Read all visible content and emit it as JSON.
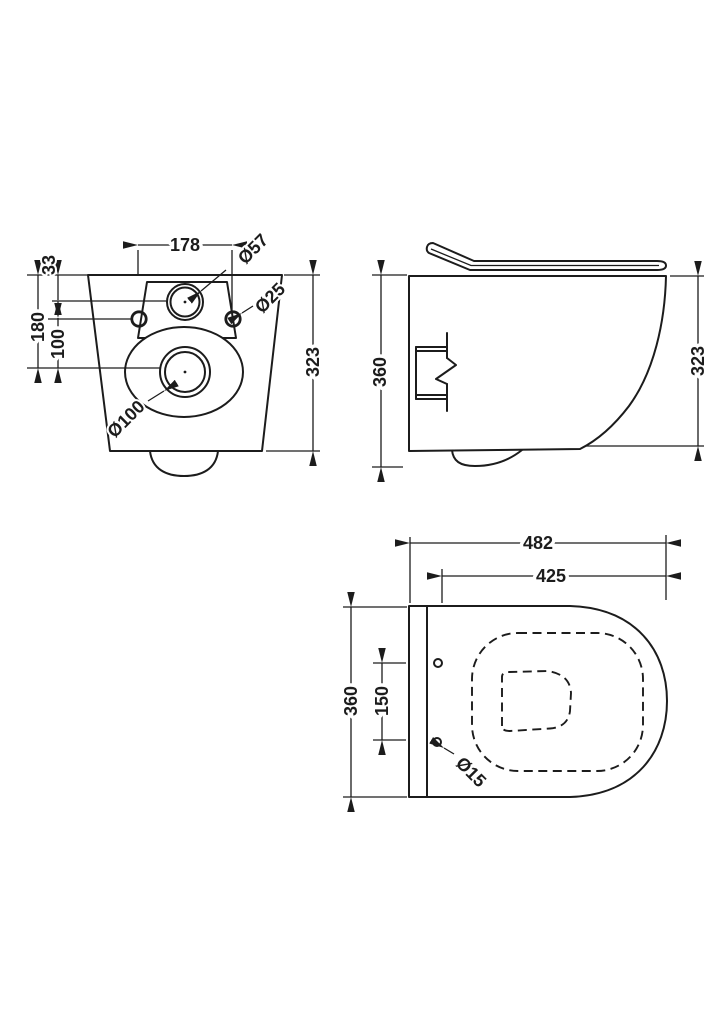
{
  "title": "Wall-hung toilet dimensioned technical drawing",
  "colors": {
    "line": "#1c1c1c",
    "background": "#ffffff"
  },
  "views": {
    "rear": {
      "dims": {
        "hole_spacing": "178",
        "inlet_dia": "Ø57",
        "fixing_hole_dia": "Ø25",
        "top_to_inlet": "33",
        "top_to_outlet_center": "180",
        "holes_to_outlet_center": "100",
        "outlet_dia": "Ø100",
        "height": "323"
      }
    },
    "side": {
      "dims": {
        "total_height": "360",
        "height": "323"
      }
    },
    "plan": {
      "dims": {
        "total_depth": "482",
        "bowl_depth": "425",
        "width": "360",
        "seat_hole_spacing": "150",
        "seat_hole_dia": "Ø15"
      }
    }
  }
}
